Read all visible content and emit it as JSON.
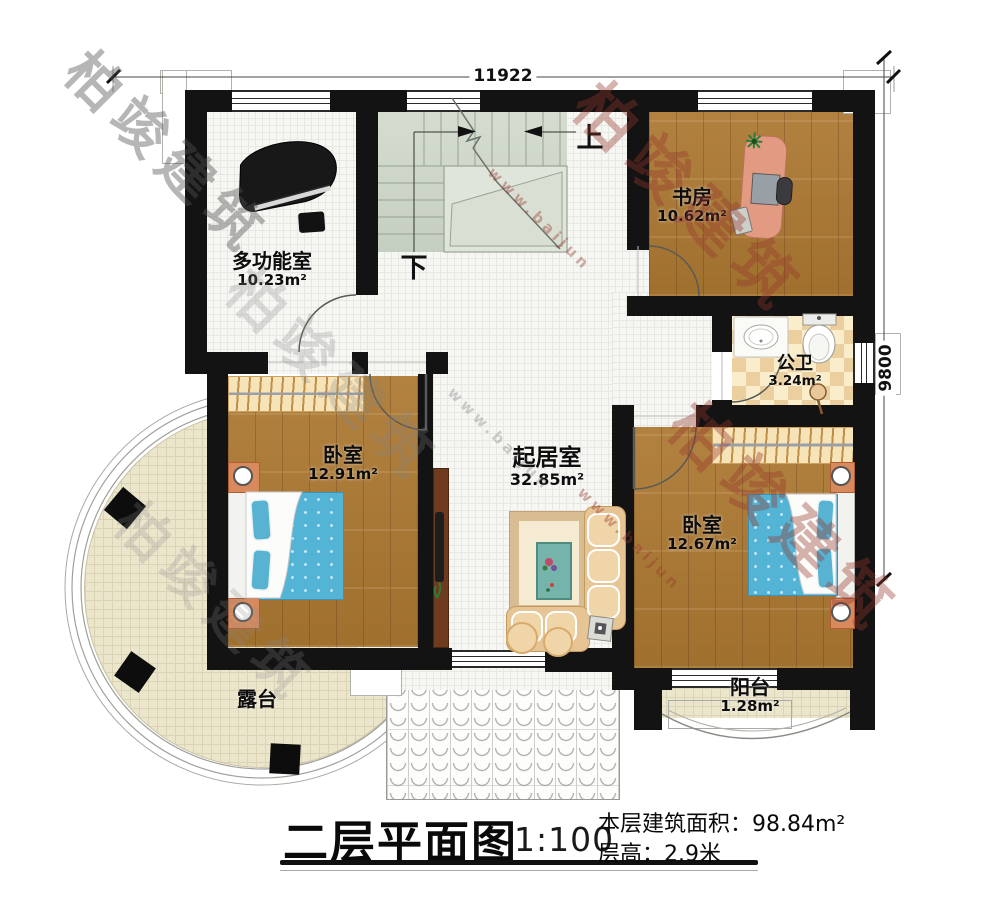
{
  "dimensions": {
    "width": "11922",
    "height": "9800"
  },
  "stairs": {
    "up": "上",
    "down": "下"
  },
  "rooms": [
    {
      "name": "多功能室",
      "area": "10.23m²"
    },
    {
      "name": "书房",
      "area": "10.62m²"
    },
    {
      "name": "公卫",
      "area": "3.24m²"
    },
    {
      "name": "卧室",
      "area": "12.91m²"
    },
    {
      "name": "起居室",
      "area": "32.85m²"
    },
    {
      "name": "卧室",
      "area": "12.67m²"
    },
    {
      "name": "露台"
    },
    {
      "name": "阳台",
      "area": "1.28m²"
    }
  ],
  "title_block": {
    "title": "二层平面图",
    "scale": "1:100",
    "area_line": "本层建筑面积：98.84m²",
    "height_line": "层高：2.9米"
  },
  "watermark": {
    "brand": "柏竣建筑",
    "url": "www.baijun"
  },
  "colors": {
    "wall": "#131313",
    "wood": "#ac7832",
    "stair": "#cdd7c8",
    "bed": "#54b4d6",
    "sofa": "#e7c493",
    "tile_light": "#f9edcb",
    "tile_dark": "#eccf9e",
    "terrace": "#ebe5cc",
    "watermark_red": "#9b3a2d"
  }
}
